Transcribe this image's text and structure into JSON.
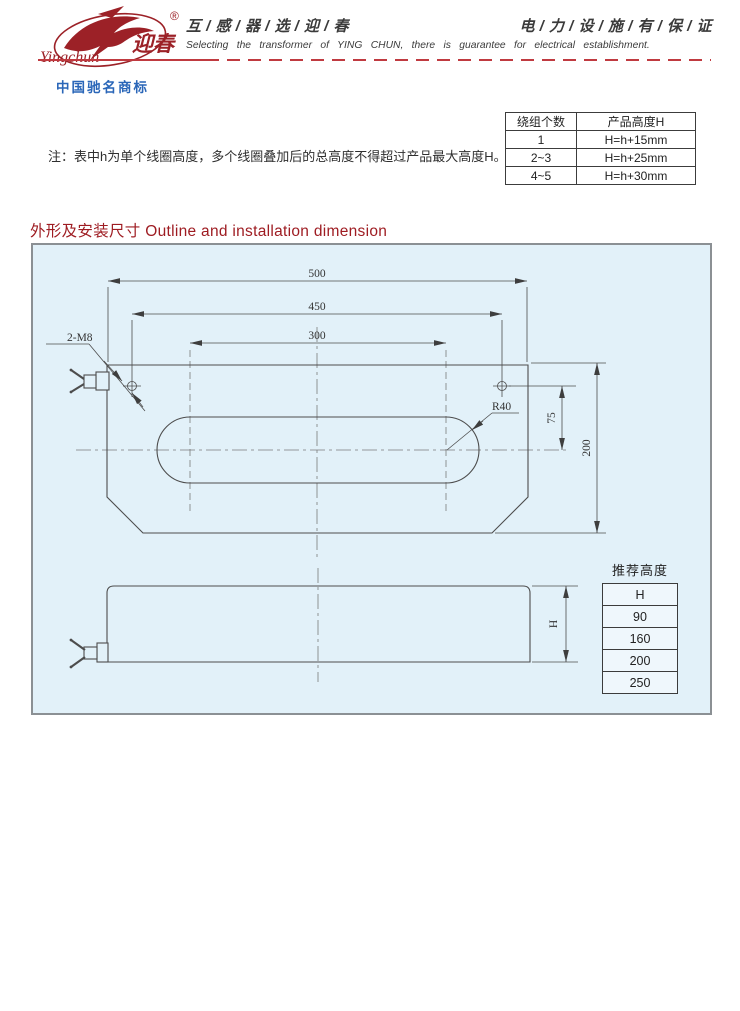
{
  "colors": {
    "brand_red": "#9c2127",
    "dash_red": "#c03a40",
    "trademark_blue": "#2a66b8",
    "title_red": "#9e1c22",
    "panel_bg": "#e2f1f9",
    "line": "#4d4d4d"
  },
  "header": {
    "brand_cn": "迎春",
    "brand_script": "Yingchun",
    "registered_mark": "®",
    "trademark_caption": "中国驰名商标",
    "slogan_cn_left": "互 / 感 / 器 / 选 / 迎 / 春",
    "slogan_cn_right": "电 / 力 / 设 / 施 / 有 / 保 / 证",
    "slogan_en": "Selecting the transformer of YING CHUN, there is guarantee for electrical establishment."
  },
  "note": "注：表中h为单个线圈高度，多个线圈叠加后的总高度不得超过产品最大高度H。",
  "winding_table": {
    "col_headers": [
      "绕组个数",
      "产品高度H"
    ],
    "rows": [
      [
        "1",
        "H=h+15mm"
      ],
      [
        "2~3",
        "H=h+25mm"
      ],
      [
        "4~5",
        "H=h+30mm"
      ]
    ]
  },
  "section_title": "外形及安装尺寸 Outline and installation dimension",
  "drawing": {
    "dim_overall_width": "500",
    "dim_hole_span": "450",
    "dim_window_span": "300",
    "label_bolt_holes": "2-M8",
    "label_corner_radius": "R40",
    "dim_hole_offset": "75",
    "dim_overall_depth": "200",
    "dim_height": "H"
  },
  "recommended_table": {
    "title": "推荐高度",
    "header": "H",
    "rows": [
      "90",
      "160",
      "200",
      "250"
    ]
  }
}
